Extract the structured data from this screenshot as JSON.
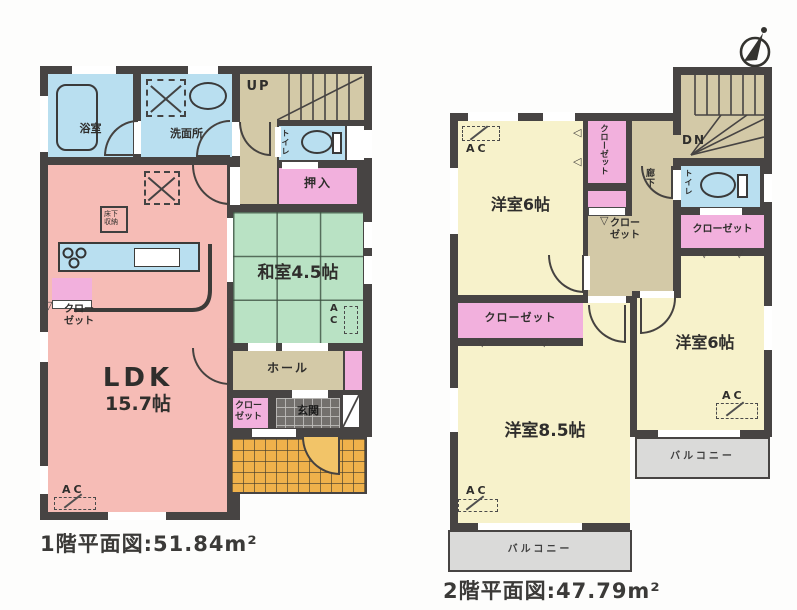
{
  "palette": {
    "wall": "#474443",
    "water_blue": "#b9dff0",
    "ldk_pink": "#f6bcb6",
    "closet_pink": "#f2b0dd",
    "tatami_green": "#b9e2c4",
    "hall_tan": "#d3c9a7",
    "room_cream": "#f7f2cb",
    "balcony_gray": "#dadad9",
    "porch_orange": "#efb14b",
    "genkan_gray": "#73706d"
  },
  "icons": {
    "fold_down": "▽",
    "fold_left": "◁",
    "north_arrow": "compass-north"
  },
  "floor1": {
    "caption": "1階平面図:51.84m²",
    "rooms": {
      "bath": "浴室",
      "washroom": "洗面所",
      "stairs": "UP",
      "toilet": "トイレ",
      "oshiire": "押入",
      "washitsu": "和室4.5帖",
      "ldk_name": "LDK",
      "ldk_size": "15.7帖",
      "underfloor": "床下収納",
      "closet_kitchen": "クローゼット",
      "hall": "ホール",
      "closet_entry": "クローゼット",
      "genkan": "玄関",
      "ac": "AC"
    }
  },
  "floor2": {
    "caption": "2階平面図:47.79m²",
    "rooms": {
      "room_nw": "洋室6帖",
      "room_e": "洋室6帖",
      "room_sw": "洋室8.5帖",
      "stairs": "DN",
      "hallway": "廊下",
      "toilet": "トイレ",
      "closet_nw": "クローゼット",
      "closet_hall": "クローゼット",
      "closet_e": "クローゼット",
      "closet_sw": "クローゼット",
      "balcony_e": "バルコニー",
      "balcony_s": "バルコニー",
      "ac": "AC"
    }
  }
}
